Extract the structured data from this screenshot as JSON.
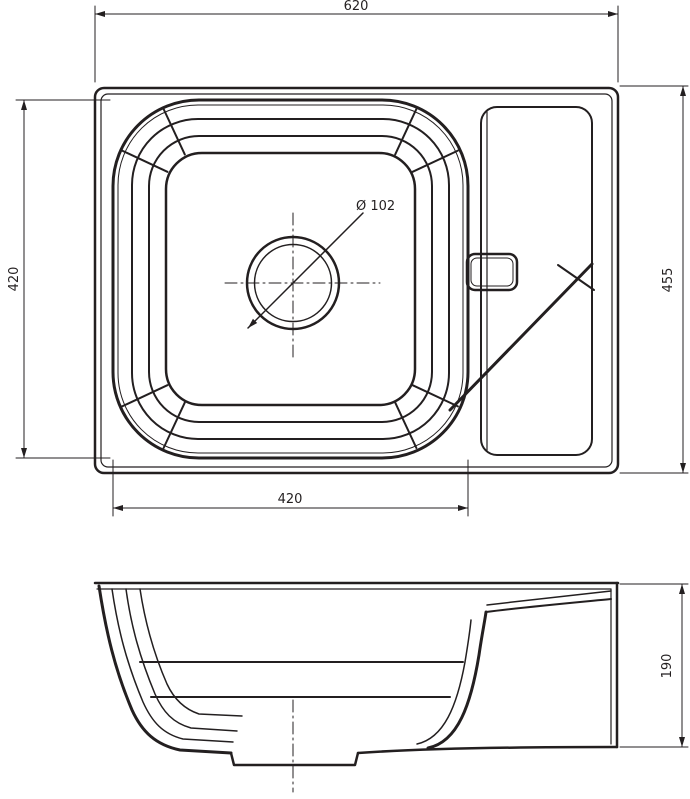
{
  "drawing": {
    "type": "technical-drawing",
    "subject": "kitchen-sink-with-drainer-section",
    "colors": {
      "line": "#231f20",
      "background": "#ffffff"
    },
    "top_view": {
      "width_label": "620",
      "depth_label": "455",
      "bowl_width_label": "420",
      "bowl_depth_label": "420",
      "drain_label": "Ø 102"
    },
    "side_view": {
      "height_label": "190"
    }
  }
}
